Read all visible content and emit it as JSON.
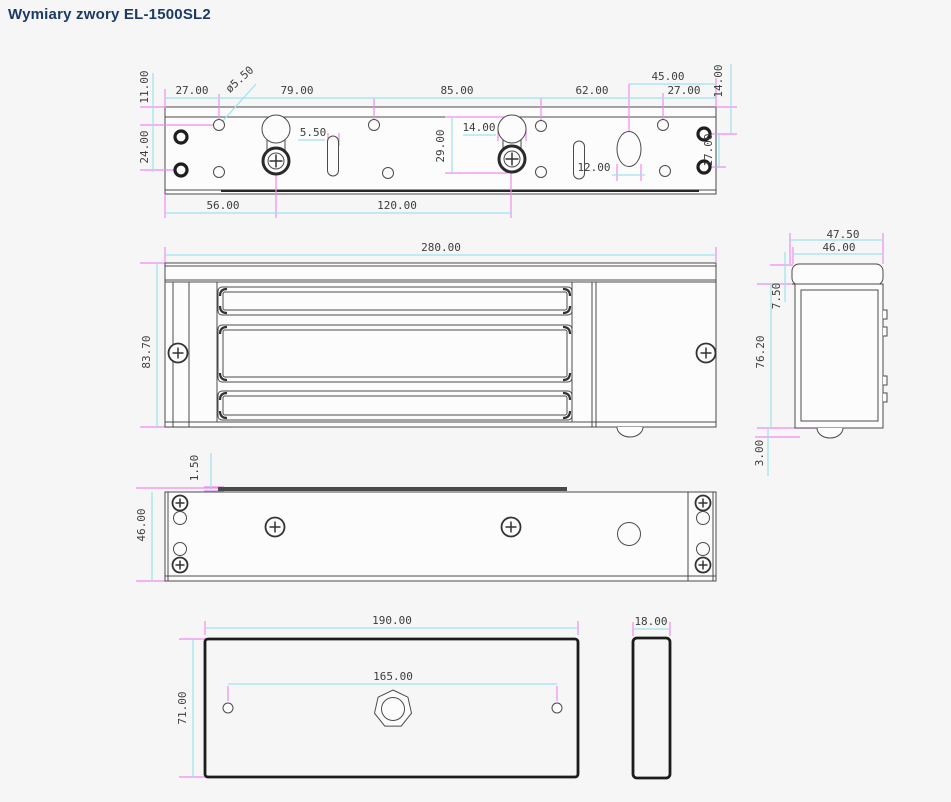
{
  "title": "Wymiary zwory EL-1500SL2",
  "colors": {
    "background": "#f6f6f6",
    "title": "#1b3a66",
    "drawing_line": "#4b4b4b",
    "dimension_line": "#9ee2ec",
    "extension_line": "#f18bf1",
    "dim_text": "#3d3d3d"
  },
  "dims": {
    "top_view": {
      "offset_top": "11.00",
      "hole_col_1": "27.00",
      "hole_diameter": "ø5.50",
      "hole_col_2": "79.00",
      "hole_col_3": "85.00",
      "hole_col_4": "62.00",
      "hole_col_5": "27.00",
      "oval_to_edge": "45.00",
      "offset_right_top": "14.00",
      "row_spacing_left": "24.00",
      "slot_width": "5.50",
      "keyhole_width": "14.00",
      "keyhole_length": "29.00",
      "oval_width": "12.00",
      "row_spacing_right": "17.00",
      "screw_offset": "56.00",
      "screw_spacing": "120.00"
    },
    "front_view": {
      "width": "280.00",
      "height": "83.70"
    },
    "side_view": {
      "overall_depth": "47.50",
      "body_depth": "46.00",
      "cap_height": "7.50",
      "body_height": "76.20",
      "pin_protrusion": "3.00"
    },
    "bottom_view": {
      "plate_thickness": "1.50",
      "depth": "46.00"
    },
    "armature_plate": {
      "width": "190.00",
      "hole_spacing": "165.00",
      "height": "71.00",
      "thickness": "18.00"
    }
  }
}
